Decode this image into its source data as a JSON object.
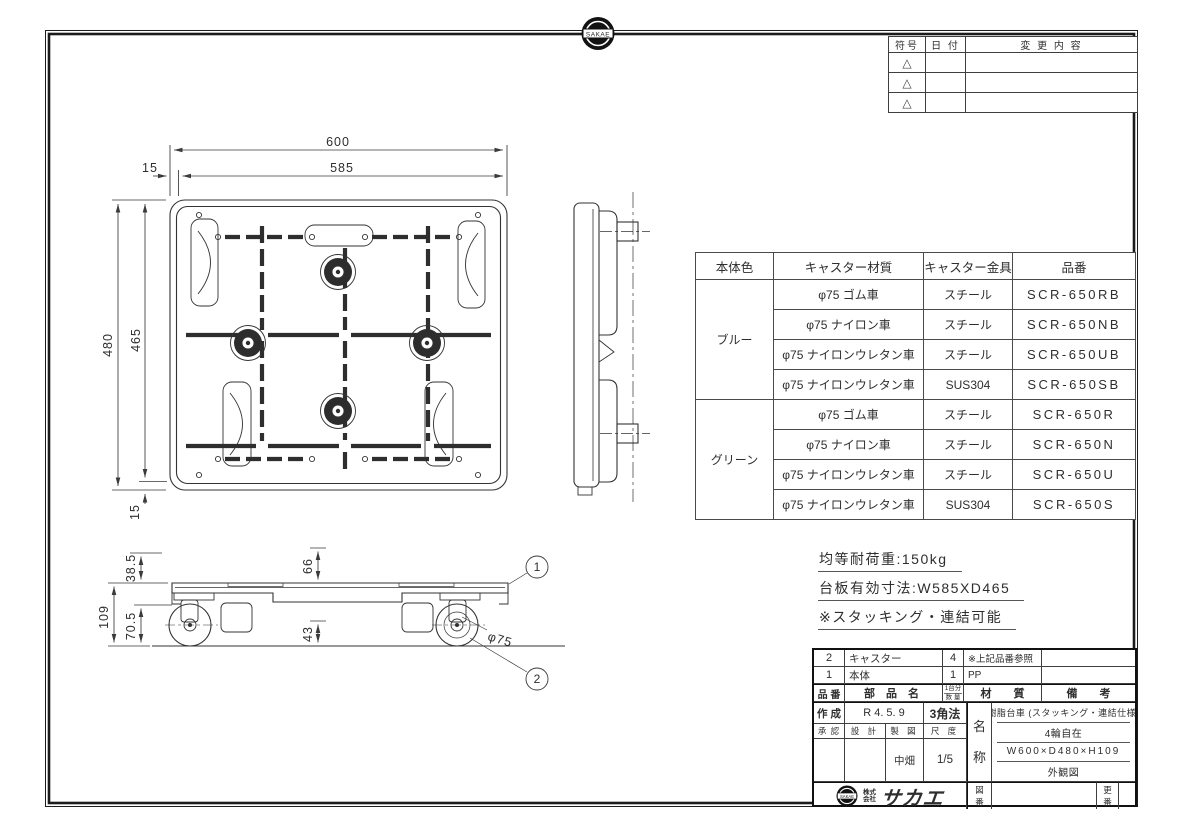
{
  "brand": {
    "badge_text": "SAKAE",
    "company_prefix_top": "株式",
    "company_prefix_bottom": "会社",
    "company_name": "サカエ"
  },
  "revision_table": {
    "col_symbol": "符号",
    "col_date": "日 付",
    "col_change": "変 更 内 容",
    "triangle": "△"
  },
  "spec_table": {
    "col_body_color": "本体色",
    "col_caster_material": "キャスター材質",
    "col_caster_bracket": "キャスター金具",
    "col_part_no": "品番",
    "rows": [
      {
        "color": "ブルー",
        "material": "φ75  ゴム車",
        "bracket": "スチール",
        "part_no": "SCR-650RB"
      },
      {
        "material": "φ75  ナイロン車",
        "bracket": "スチール",
        "part_no": "SCR-650NB"
      },
      {
        "material": "φ75  ナイロンウレタン車",
        "bracket": "スチール",
        "part_no": "SCR-650UB"
      },
      {
        "material": "φ75  ナイロンウレタン車",
        "bracket": "SUS304",
        "part_no": "SCR-650SB"
      },
      {
        "color": "グリーン",
        "material": "φ75  ゴム車",
        "bracket": "スチール",
        "part_no": "SCR-650R"
      },
      {
        "material": "φ75  ナイロン車",
        "bracket": "スチール",
        "part_no": "SCR-650N"
      },
      {
        "material": "φ75  ナイロンウレタン車",
        "bracket": "スチール",
        "part_no": "SCR-650U"
      },
      {
        "material": "φ75  ナイロンウレタン車",
        "bracket": "SUS304",
        "part_no": "SCR-650S"
      }
    ]
  },
  "notes": {
    "load": "均等耐荷重:150kg",
    "deck_size": "台板有効寸法:W585XD465",
    "stacking": "※スタッキング・連結可能"
  },
  "dims": {
    "w600": "600",
    "w585": "585",
    "off15_left": "15",
    "d480": "480",
    "d465": "465",
    "off15_bottom": "15",
    "h385": "38.5",
    "h109": "109",
    "h705": "70.5",
    "h66": "66",
    "h43": "43",
    "wheel_dia": "φ75",
    "balloon1": "1",
    "balloon2": "2"
  },
  "title_block": {
    "parts": [
      {
        "no": "2",
        "name": "キャスター",
        "qty": "4",
        "material": "※上記品番参照",
        "remarks": ""
      },
      {
        "no": "1",
        "name": "本体",
        "qty": "1",
        "material": "PP",
        "remarks": ""
      }
    ],
    "headers": {
      "no": "品 番",
      "name": "部  品  名",
      "qty_line1": "1台分",
      "qty_line2": "数 量",
      "material": "材　　質",
      "remarks": "備　　考"
    },
    "created_label": "作 成",
    "created_date": "R 4.  5.  9",
    "projection": "3角法",
    "approval": "承 認",
    "design": "設 計",
    "drafting": "製 図",
    "scale_label": "尺 度",
    "drafter": "中畑",
    "scale": "1/5",
    "name_label_1": "名",
    "name_label_2": "称",
    "product_lines": [
      "樹脂台車 (スタッキング・連結仕様)",
      "4輪自在",
      "W600×D480×H109",
      "外観図"
    ],
    "drawing_no_label_1": "図",
    "drawing_no_label_2": "番",
    "rev_label_1": "更",
    "rev_label_2": "番"
  }
}
